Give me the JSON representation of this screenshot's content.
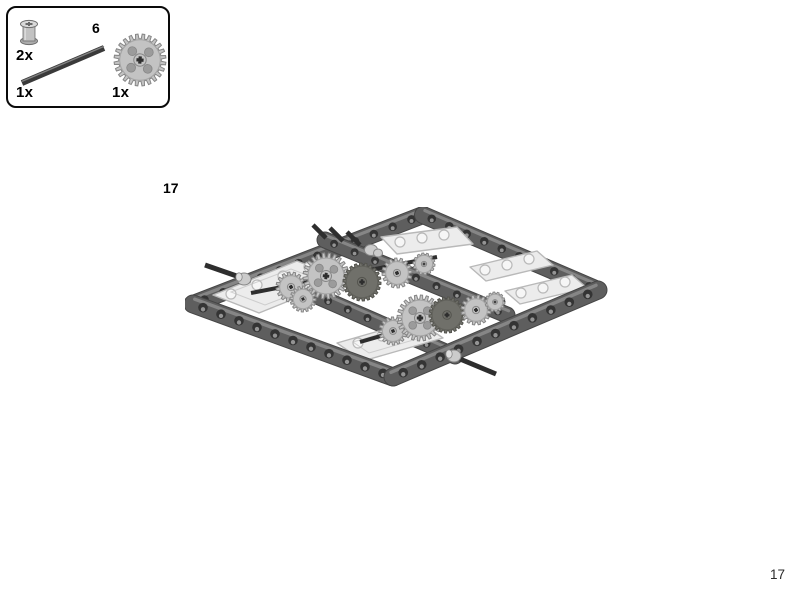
{
  "page": {
    "step_number": "17",
    "page_number": "17"
  },
  "parts_box": {
    "items": [
      {
        "name": "technic-bushing",
        "qty": "2x"
      },
      {
        "name": "technic-axle-6",
        "qty": "1x",
        "length_label": "6"
      },
      {
        "name": "technic-gear-24-tooth",
        "qty": "1x"
      }
    ]
  },
  "colors": {
    "box_border": "#0a0a0a",
    "beam": "#5e5e5e",
    "beam_edge": "#454545",
    "beam_top": "#8b8b8b",
    "hole": "#343434",
    "hole_hl": "#a6a6a6",
    "plate": "#ececec",
    "plate_edge": "#b9b9b9",
    "plate_hole": "#f6f6f6",
    "gear_light": "#c3c3c3",
    "gear_edge": "#868686",
    "gear_dark": "#70706a",
    "gear_dark_edge": "#54544e",
    "gear_hole": "#9b9b9b",
    "axle": "#2e2e2e",
    "bushing": "#cbcbcb",
    "page_text": "#2b2b2b"
  }
}
